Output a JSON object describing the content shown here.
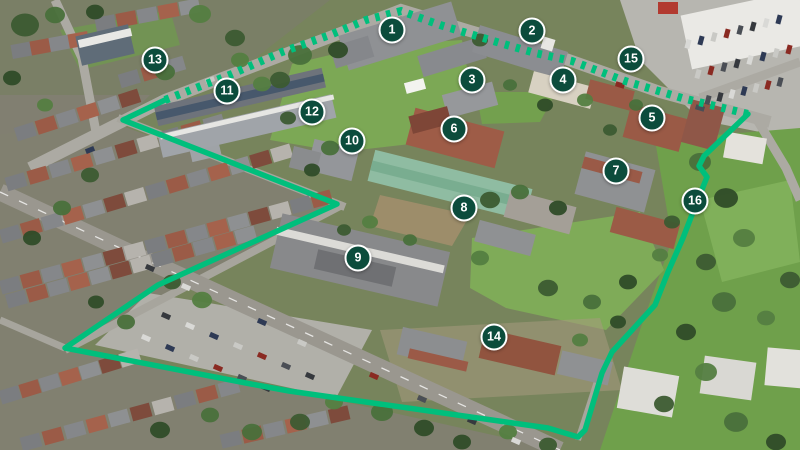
{
  "map": {
    "markers": [
      {
        "label": "1",
        "x": 392,
        "y": 30
      },
      {
        "label": "2",
        "x": 532,
        "y": 31
      },
      {
        "label": "3",
        "x": 472,
        "y": 80
      },
      {
        "label": "4",
        "x": 563,
        "y": 80
      },
      {
        "label": "5",
        "x": 652,
        "y": 118
      },
      {
        "label": "6",
        "x": 454,
        "y": 129
      },
      {
        "label": "7",
        "x": 616,
        "y": 171
      },
      {
        "label": "8",
        "x": 464,
        "y": 208
      },
      {
        "label": "9",
        "x": 358,
        "y": 258
      },
      {
        "label": "10",
        "x": 352,
        "y": 141
      },
      {
        "label": "11",
        "x": 227,
        "y": 91
      },
      {
        "label": "12",
        "x": 312,
        "y": 112
      },
      {
        "label": "13",
        "x": 155,
        "y": 60
      },
      {
        "label": "14",
        "x": 494,
        "y": 337
      },
      {
        "label": "15",
        "x": 631,
        "y": 59
      },
      {
        "label": "16",
        "x": 695,
        "y": 201
      }
    ],
    "boundary": {
      "dashed_path": "M 165,100 L 232,74 L 282,52 L 330,35 L 366,20 L 401,11 L 440,25 L 500,43 L 535,53 L 572,61 L 625,81 L 682,98 L 748,114",
      "solid_path": "M 748,114 L 704,156 L 699,166 L 707,177 L 695,207 L 683,238 L 668,272 L 655,305 L 612,352 L 602,373 L 585,430 L 578,437 L 548,428 L 289,391 L 251,384 L 65,348 L 158,285 L 337,204 L 123,120 L 165,100"
    },
    "colors": {
      "boundary_line": "#00BF7C",
      "marker_fill": "#0C4C3C",
      "marker_border": "#FFFFFF",
      "marker_text": "#FFFFFF"
    }
  }
}
